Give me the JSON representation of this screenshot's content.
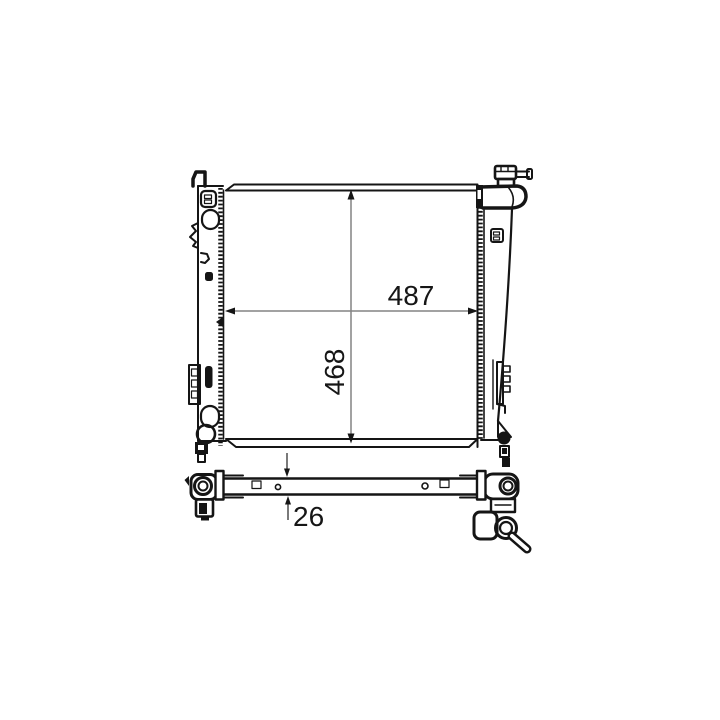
{
  "diagram": {
    "type": "technical-line-drawing",
    "subject": "automotive radiator, front view and bottom (thickness) view",
    "background": "#ffffff",
    "line_color": "#151515",
    "dimension_line_color": "#838383",
    "dimension_text_color": "#161616",
    "dimensions": {
      "width": "487",
      "height": "468",
      "depth": "26"
    }
  }
}
